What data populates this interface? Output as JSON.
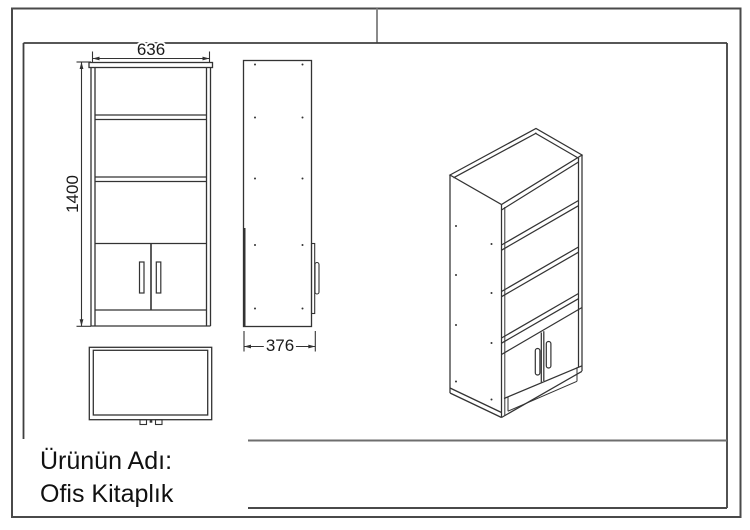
{
  "sheet": {
    "background": "#ffffff",
    "frame_color": "#4a4a4a",
    "divider_color": "#8a8a8a",
    "line_color": "#333333",
    "text_color": "#111111"
  },
  "title_block": {
    "product_label": "Ürünün Adı:",
    "product_name": "Ofis Kitaplık"
  },
  "dimensions": {
    "width_label": "636",
    "height_label": "1400",
    "depth_label": "376"
  }
}
